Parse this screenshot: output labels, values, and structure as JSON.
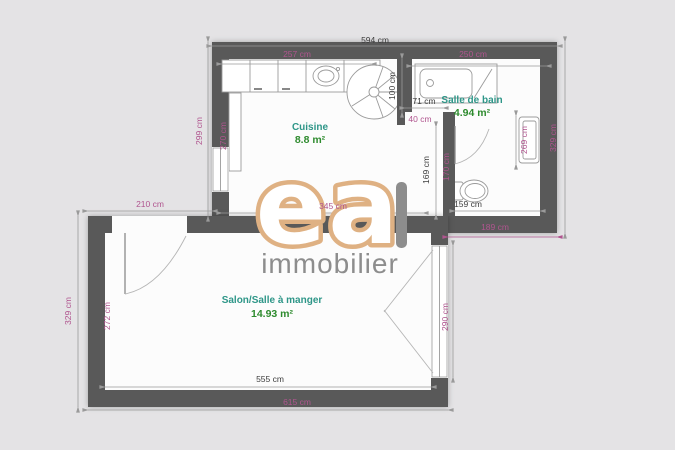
{
  "colors": {
    "bg": "#e4e3e5",
    "wall": "#595959",
    "floor": "#fcfcfc",
    "dim_dark": "#3c3c3c",
    "dim_pink": "#b0558f",
    "dim_line": "#9a9a9a",
    "room_name": "#2e9688",
    "room_area": "#2e8b2e",
    "logo_gold": "#dfb183",
    "logo_gray": "#8d8d8d"
  },
  "logo": {
    "brand": "ea",
    "subtitle": "immobilier"
  },
  "plan": {
    "rooms": {
      "kitchen": {
        "name": "Cuisine",
        "area": "8.8 m²"
      },
      "bathroom": {
        "name": "Salle de bain",
        "area": "4.94 m²"
      },
      "living": {
        "name": "Salon/Salle à manger",
        "area": "14.93 m²"
      }
    },
    "dims": {
      "top_width": "594 cm",
      "upper_left_height": "299 cm",
      "upper_right_height": "329 cm",
      "kitchen_left_inner": "270 cm",
      "counter_width": "257 cm",
      "bath_top_width": "250 cm",
      "divider_length": "100 cm",
      "bath_door_width": "71 cm",
      "wall_return": "40 cm",
      "bath_right_inner": "269 cm",
      "corridor_height": "169 cm",
      "corridor_wall": "170 cm",
      "toilet_wall_width": "159 cm",
      "bath_overhang": "189 cm",
      "kitchen_width": "345 cm",
      "offset_left": "210 cm",
      "lower_left_height": "329 cm",
      "salon_left_inner": "272 cm",
      "window_height": "290 cm",
      "salon_inner_width": "555 cm",
      "bottom_width": "615 cm"
    }
  }
}
